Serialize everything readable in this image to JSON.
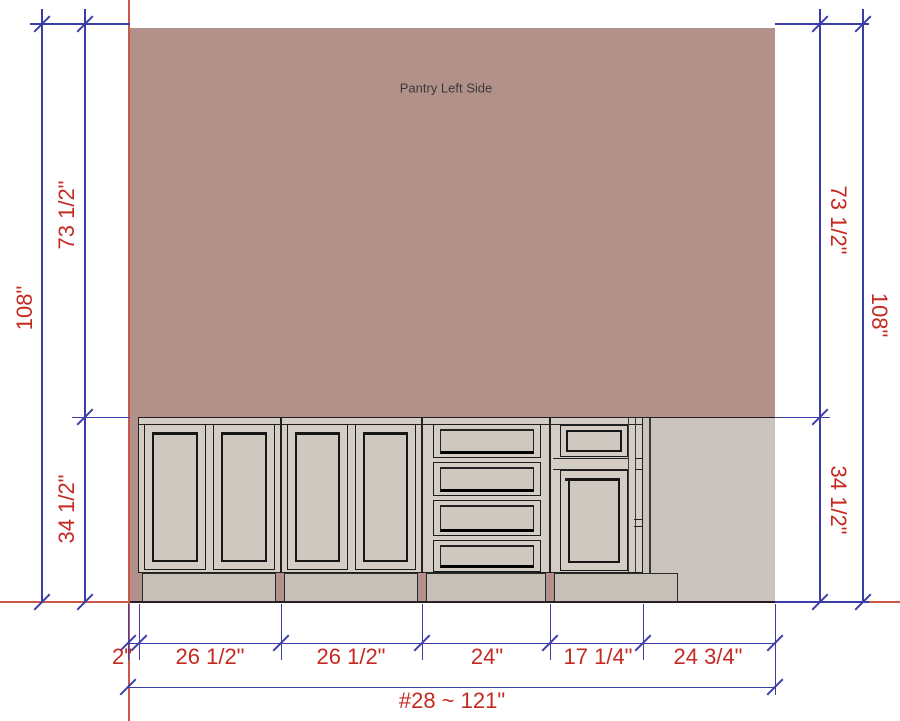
{
  "drawing_title": "Pantry Left Side",
  "wall": {
    "label": "Pantry Left Side"
  },
  "dimensions": {
    "left": {
      "overall": "108\"",
      "upper": "73 1/2\"",
      "lower": "34 1/2\""
    },
    "right": {
      "overall": "108\"",
      "upper": "73 1/2\"",
      "lower": "34 1/2\""
    },
    "bottom": {
      "segments": [
        "2\"",
        "26 1/2\"",
        "26 1/2\"",
        "24\"",
        "17 1/4\"",
        "24 3/4\""
      ],
      "overall": "#28 ~ 121\""
    }
  },
  "cabinets": [
    {
      "type": "base-two-door",
      "width_label": "26 1/2\""
    },
    {
      "type": "base-two-door",
      "width_label": "26 1/2\""
    },
    {
      "type": "base-four-drawer",
      "width_label": "24\""
    },
    {
      "type": "base-drawer-over-door",
      "width_label": "17 1/4\""
    }
  ],
  "open_wall_width_label": "24 3/4\"",
  "colors": {
    "wall": "#b2918b",
    "wall_lower": "#cbc4be",
    "cabinet_face": "#d3cdc5",
    "cabinet_panel": "#cec8c0",
    "toe_kick": "#c7c0b8",
    "dimension_line": "#3d3daa",
    "dimension_text": "#c42a21",
    "construction_line": "#c9574c",
    "outline": "#1f1f1f",
    "label_text": "#3c3838"
  }
}
